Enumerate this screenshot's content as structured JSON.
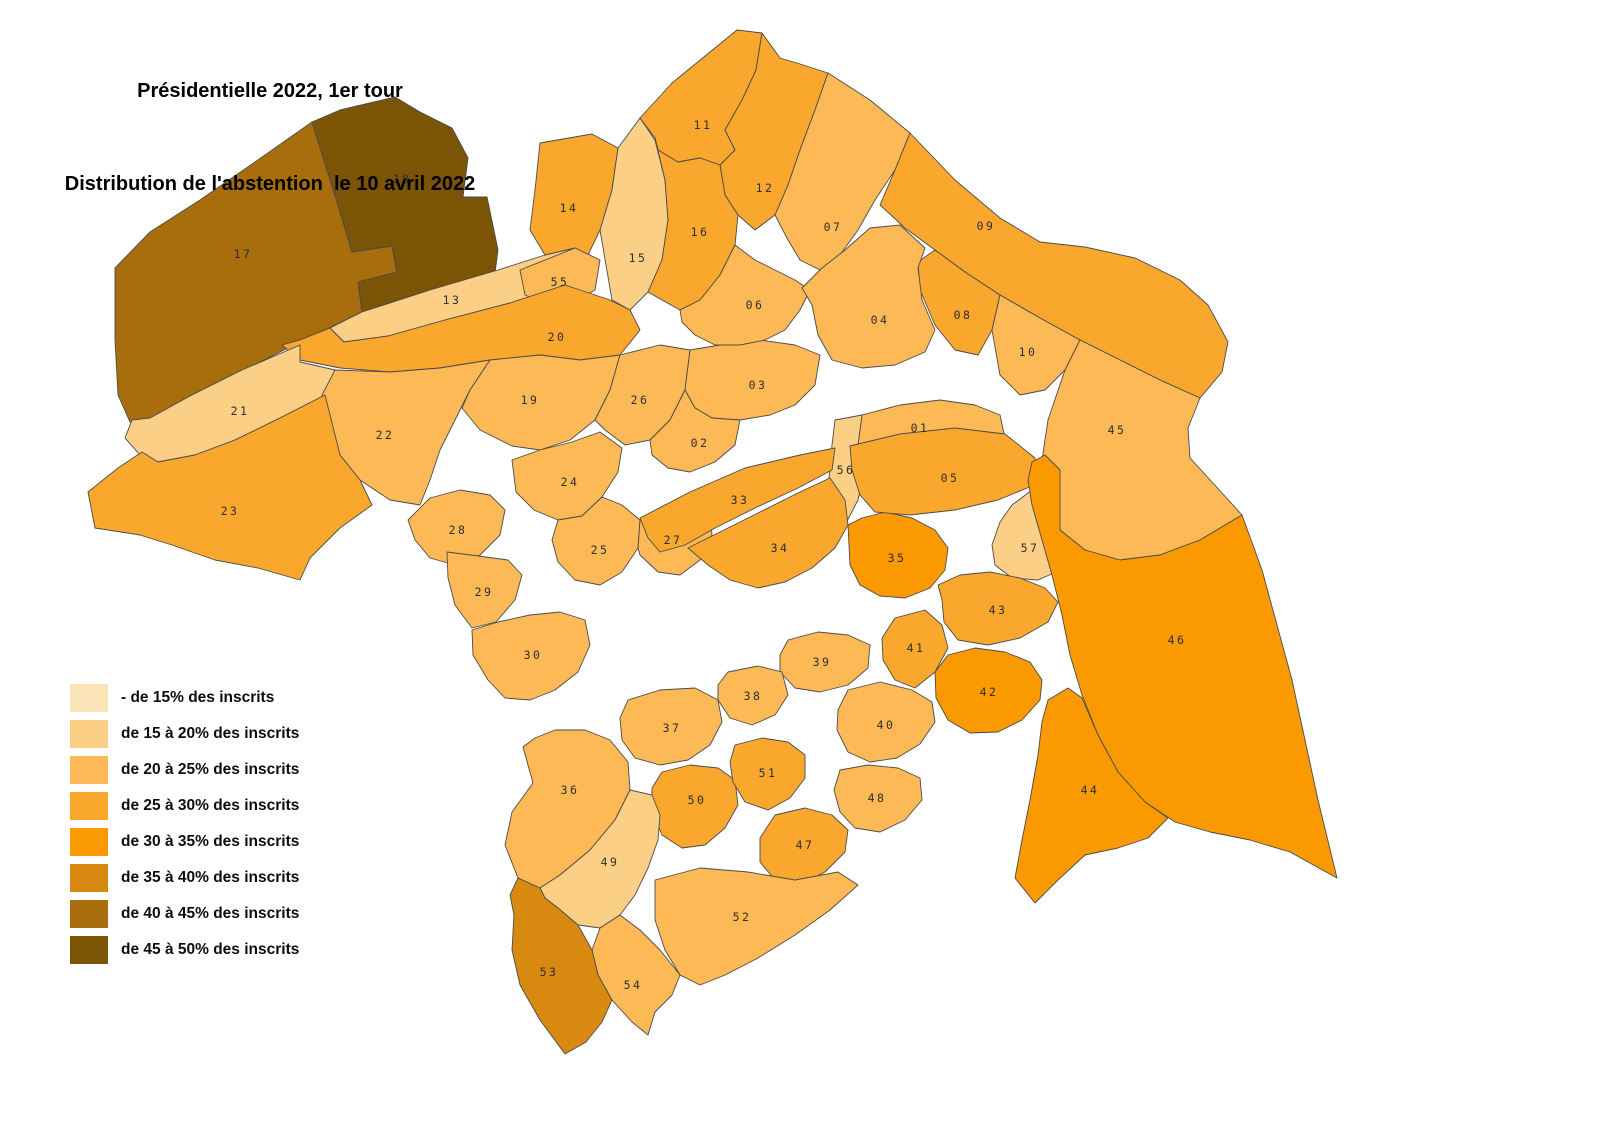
{
  "title": {
    "line1": "Présidentielle 2022, 1er tour",
    "line2": "Distribution de l'abstention  le 10 avril 2022"
  },
  "legend": {
    "items": [
      {
        "label": "- de 15% des inscrits",
        "color": "#fbe3b8"
      },
      {
        "label": "de 15 à 20% des inscrits",
        "color": "#fccf87"
      },
      {
        "label": "de 20 à 25% des inscrits",
        "color": "#fcb955"
      },
      {
        "label": "de 25 à 30% des inscrits",
        "color": "#faa72e"
      },
      {
        "label": "de 30 à 35% des inscrits",
        "color": "#fb9901"
      },
      {
        "label": "de 35 à 40% des inscrits",
        "color": "#d8890f"
      },
      {
        "label": "de 40 à 45% des inscrits",
        "color": "#a86d0c"
      },
      {
        "label": "de 45 à 50% des inscrits",
        "color": "#7b5406"
      }
    ]
  },
  "map": {
    "background": "#ffffff",
    "border_color": "#4a4a4a",
    "label_color": "#2e2e2e",
    "districts": [
      {
        "id": "17",
        "class": 6,
        "label": [
          243,
          254
        ],
        "points": "115,268 150,232 200,200 255,162 312,122 338,205 352,252 392,246 397,272 358,282 362,312 300,342 240,372 188,398 150,420 130,422 118,395 115,340"
      },
      {
        "id": "18",
        "class": 7,
        "label": [
          402,
          179
        ],
        "points": "312,122 340,110 395,97 420,112 452,128 468,158 463,197 487,197 498,250 495,273 430,292 362,312 358,282 397,272 392,246 352,252 338,205"
      },
      {
        "id": "13",
        "class": 1,
        "label": [
          452,
          300
        ],
        "points": "362,312 430,290 498,270 545,255 575,248 565,285 510,303 445,320 388,336 344,342 330,328"
      },
      {
        "id": "14",
        "class": 3,
        "label": [
          569,
          208
        ],
        "points": "540,143 592,134 618,148 612,190 600,230 588,255 575,248 545,255 530,230 535,190"
      },
      {
        "id": "15",
        "class": 1,
        "label": [
          638,
          258
        ],
        "points": "618,148 640,118 655,140 665,180 668,220 662,260 648,292 630,310 612,300 600,230 612,190"
      },
      {
        "id": "11",
        "class": 3,
        "label": [
          703,
          125
        ],
        "points": "640,118 672,83 710,52 737,30 762,33 756,70 742,100 725,130 735,150 720,165 700,158 678,162 658,150 655,138"
      },
      {
        "id": "12",
        "class": 3,
        "label": [
          765,
          188
        ],
        "points": "762,33 780,58 800,64 828,73 815,110 800,150 788,185 775,215 755,230 738,215 725,195 720,165 735,150 725,130 742,100 756,70"
      },
      {
        "id": "16",
        "class": 3,
        "label": [
          700,
          232
        ],
        "points": "655,138 658,150 678,162 700,158 720,165 725,195 738,215 735,245 720,275 700,300 680,310 662,300 648,292 662,260 668,220 665,180"
      },
      {
        "id": "07",
        "class": 2,
        "label": [
          833,
          227
        ],
        "points": "800,150 815,110 828,73 870,100 910,133 895,170 875,200 858,230 840,255 820,270 800,260 788,240 775,215 788,185"
      },
      {
        "id": "09",
        "class": 3,
        "label": [
          986,
          226
        ],
        "points": "910,133 955,180 1000,218 1040,242 1085,247 1135,258 1180,280 1208,305 1228,342 1222,372 1200,398 1160,380 1120,360 1080,340 1040,318 1000,295 965,272 935,250 905,228 880,205 895,170"
      },
      {
        "id": "08",
        "class": 3,
        "label": [
          963,
          315
        ],
        "points": "935,250 965,272 1000,295 992,330 978,355 955,350 935,325 920,290 918,262"
      },
      {
        "id": "10",
        "class": 2,
        "label": [
          1028,
          352
        ],
        "points": "1000,295 1040,318 1080,340 1065,370 1045,390 1020,395 1000,375 992,330"
      },
      {
        "id": "45",
        "class": 2,
        "label": [
          1117,
          430
        ],
        "points": "1080,340 1120,360 1160,380 1200,398 1188,428 1190,458 1212,482 1242,515 1200,540 1160,555 1120,560 1085,550 1060,530 1045,500 1042,460 1048,420 1065,370"
      },
      {
        "id": "55",
        "class": 2,
        "label": [
          560,
          282
        ],
        "points": "520,270 575,248 600,260 595,290 560,310 525,295"
      },
      {
        "id": "20",
        "class": 3,
        "label": [
          557,
          337
        ],
        "points": "330,328 344,342 388,336 445,320 510,303 565,285 610,300 630,310 640,330 620,355 580,360 540,355 490,360 440,368 390,372 340,368 300,360 282,345 300,340"
      },
      {
        "id": "21",
        "class": 1,
        "label": [
          240,
          411
        ],
        "points": "125,438 132,420 150,418 190,396 242,370 300,345 300,362 335,370 325,395 280,418 235,440 195,455 158,462 140,455"
      },
      {
        "id": "22",
        "class": 2,
        "label": [
          385,
          435
        ],
        "points": "335,370 390,372 440,368 490,360 470,390 455,420 440,450 430,480 420,505 390,500 360,480 340,455 325,430 322,395"
      },
      {
        "id": "19",
        "class": 2,
        "label": [
          530,
          400
        ],
        "points": "490,360 540,355 580,360 620,355 610,390 595,420 570,440 540,450 512,446 480,430 462,408 470,390"
      },
      {
        "id": "26",
        "class": 2,
        "label": [
          640,
          400
        ],
        "points": "620,355 660,345 690,350 685,390 670,420 650,440 625,445 605,430 595,420 610,390"
      },
      {
        "id": "23",
        "class": 3,
        "label": [
          230,
          511
        ],
        "points": "88,492 118,468 142,452 158,462 195,455 235,440 280,418 325,395 340,455 360,480 372,505 340,528 310,558 300,580 258,568 215,560 172,545 140,535 95,528"
      },
      {
        "id": "24",
        "class": 2,
        "label": [
          570,
          482
        ],
        "points": "512,460 540,450 572,442 600,432 622,448 618,472 602,497 582,516 558,520 534,510 516,492"
      },
      {
        "id": "28",
        "class": 2,
        "label": [
          458,
          530
        ],
        "points": "408,520 430,498 460,490 490,495 505,510 500,535 480,555 455,565 430,558 415,540"
      },
      {
        "id": "25",
        "class": 2,
        "label": [
          600,
          550
        ],
        "points": "558,520 582,516 602,497 622,505 640,520 638,548 622,572 600,585 575,580 558,562 552,540"
      },
      {
        "id": "27",
        "class": 2,
        "label": [
          673,
          540
        ],
        "points": "640,520 665,505 690,500 710,510 712,535 700,560 680,575 658,572 640,555 638,548"
      },
      {
        "id": "29",
        "class": 2,
        "label": [
          484,
          592
        ],
        "points": "447,552 478,556 508,560 522,575 515,600 496,622 472,628 455,605 448,578"
      },
      {
        "id": "30",
        "class": 2,
        "label": [
          533,
          655
        ],
        "points": "472,630 498,622 530,615 560,612 585,620 590,645 578,672 555,690 530,700 505,698 488,680 473,655"
      },
      {
        "id": "03",
        "class": 2,
        "label": [
          758,
          385
        ],
        "points": "685,390 690,350 720,345 760,340 795,345 820,355 815,385 795,405 770,415 740,420 712,418 695,408"
      },
      {
        "id": "02",
        "class": 2,
        "label": [
          700,
          443
        ],
        "points": "650,440 670,420 685,390 695,408 712,418 740,420 735,445 715,462 690,472 668,468 652,455"
      },
      {
        "id": "06",
        "class": 2,
        "label": [
          755,
          305
        ],
        "points": "680,310 700,300 720,275 735,245 755,260 775,270 795,280 810,290 800,310 785,330 765,340 740,345 715,345 695,335 682,322"
      },
      {
        "id": "04",
        "class": 2,
        "label": [
          880,
          320
        ],
        "points": "822,268 845,250 870,228 900,225 925,248 918,268 922,300 935,330 925,352 895,365 862,368 832,360 818,335 812,305 802,288"
      },
      {
        "id": "01",
        "class": 2,
        "label": [
          920,
          428
        ],
        "points": "862,415 900,405 940,400 975,405 1000,415 1005,438 975,445 940,448 905,452 875,455 865,470 858,445"
      },
      {
        "id": "56",
        "class": 1,
        "label": [
          846,
          470
        ],
        "points": "835,420 862,415 858,445 865,470 858,500 845,525 830,530 825,505 830,470 832,445"
      },
      {
        "id": "33",
        "class": 3,
        "label": [
          740,
          500
        ],
        "points": "640,518 690,492 745,468 800,455 835,448 832,470 798,488 755,508 715,528 685,545 660,552 648,538"
      },
      {
        "id": "34",
        "class": 3,
        "label": [
          780,
          548
        ],
        "points": "688,548 720,532 760,512 800,492 830,478 845,500 848,525 835,548 812,568 785,582 758,588 730,580 708,565"
      },
      {
        "id": "35",
        "class": 4,
        "label": [
          897,
          558
        ],
        "points": "848,525 862,518 885,512 912,518 935,530 948,548 945,570 930,588 905,598 880,596 860,585 850,565"
      },
      {
        "id": "05",
        "class": 3,
        "label": [
          950,
          478
        ],
        "points": "850,446 900,434 955,428 1005,434 1035,458 1032,486 998,500 955,510 910,515 875,512 860,495 852,470"
      },
      {
        "id": "57",
        "class": 1,
        "label": [
          1030,
          548
        ],
        "points": "1012,505 1032,490 1045,510 1060,530 1080,548 1065,568 1038,580 1012,578 995,565 992,545 1000,522"
      },
      {
        "id": "43",
        "class": 3,
        "label": [
          998,
          610
        ],
        "points": "942,600 938,585 960,575 990,572 1020,578 1045,588 1058,602 1048,622 1020,638 988,645 958,640 944,622"
      },
      {
        "id": "41",
        "class": 3,
        "label": [
          916,
          648
        ],
        "points": "882,638 895,618 925,610 942,625 948,648 935,672 915,688 895,680 883,660"
      },
      {
        "id": "42",
        "class": 4,
        "label": [
          989,
          692
        ],
        "points": "935,672 948,655 975,648 1005,652 1030,662 1042,680 1040,700 1022,720 998,732 970,733 948,720 936,698"
      },
      {
        "id": "46",
        "class": 4,
        "label": [
          1177,
          640
        ],
        "points": "1032,462 1045,455 1060,470 1060,530 1085,550 1120,560 1160,555 1200,540 1242,515 1262,570 1292,680 1318,800 1337,878 1290,852 1250,840 1210,832 1175,822 1145,802 1118,772 1098,735 1082,695 1070,655 1062,615 1052,575 1042,540 1032,505 1028,480"
      },
      {
        "id": "44",
        "class": 4,
        "label": [
          1090,
          790
        ],
        "points": "1048,700 1068,688 1082,698 1098,735 1118,772 1145,802 1168,818 1148,838 1118,848 1085,855 1058,880 1035,903 1015,878 1022,840 1030,800 1038,755 1042,722"
      },
      {
        "id": "40",
        "class": 2,
        "label": [
          886,
          725
        ],
        "points": "838,710 848,690 880,682 912,690 932,702 935,722 920,744 897,758 870,762 848,752 837,730"
      },
      {
        "id": "48",
        "class": 2,
        "label": [
          877,
          798
        ],
        "points": "840,770 868,765 898,768 920,778 922,800 905,820 880,832 855,828 840,812 834,790"
      },
      {
        "id": "39",
        "class": 2,
        "label": [
          822,
          662
        ],
        "points": "780,655 788,640 818,632 848,635 870,645 868,668 848,685 820,692 795,688 780,672"
      },
      {
        "id": "38",
        "class": 2,
        "label": [
          753,
          696
        ],
        "points": "718,685 728,672 758,666 782,672 788,695 775,715 752,725 730,718 718,700"
      },
      {
        "id": "37",
        "class": 2,
        "label": [
          672,
          728
        ],
        "points": "620,718 628,700 660,690 695,688 718,700 722,722 710,745 688,760 660,765 635,758 622,740"
      },
      {
        "id": "36",
        "class": 2,
        "label": [
          570,
          790
        ],
        "points": "523,747 535,738 555,730 585,730 610,740 628,762 630,790 615,820 590,850 560,875 540,888 518,878 505,845 512,812 533,783"
      },
      {
        "id": "50",
        "class": 3,
        "label": [
          697,
          800
        ],
        "points": "652,788 662,772 690,765 718,768 735,780 738,805 725,828 705,845 682,848 662,835 652,812"
      },
      {
        "id": "51",
        "class": 3,
        "label": [
          768,
          773
        ],
        "points": "730,762 735,745 762,738 788,742 805,755 805,778 790,798 768,810 745,802 733,782"
      },
      {
        "id": "47",
        "class": 3,
        "label": [
          805,
          845
        ],
        "points": "760,838 775,815 805,808 832,815 848,830 845,852 825,872 800,885 775,880 760,862"
      },
      {
        "id": "49",
        "class": 1,
        "label": [
          610,
          862
        ],
        "points": "540,888 560,875 590,850 615,820 630,790 652,795 660,815 658,840 648,868 635,895 620,915 600,928 578,925 558,908 545,898"
      },
      {
        "id": "52",
        "class": 2,
        "label": [
          742,
          917
        ],
        "points": "655,880 700,868 748,872 795,880 838,872 858,885 830,910 795,935 758,958 725,975 700,985 680,975 665,950 655,920"
      },
      {
        "id": "54",
        "class": 2,
        "label": [
          633,
          985
        ],
        "points": "592,950 600,928 620,915 640,930 660,950 680,975 672,995 655,1012 648,1035 632,1022 612,1000 598,975"
      },
      {
        "id": "53",
        "class": 5,
        "label": [
          549,
          972
        ],
        "points": "510,895 518,878 540,888 545,898 558,908 578,925 592,950 598,975 612,1000 602,1022 586,1042 565,1054 540,1020 520,985 512,950 514,915"
      }
    ]
  }
}
